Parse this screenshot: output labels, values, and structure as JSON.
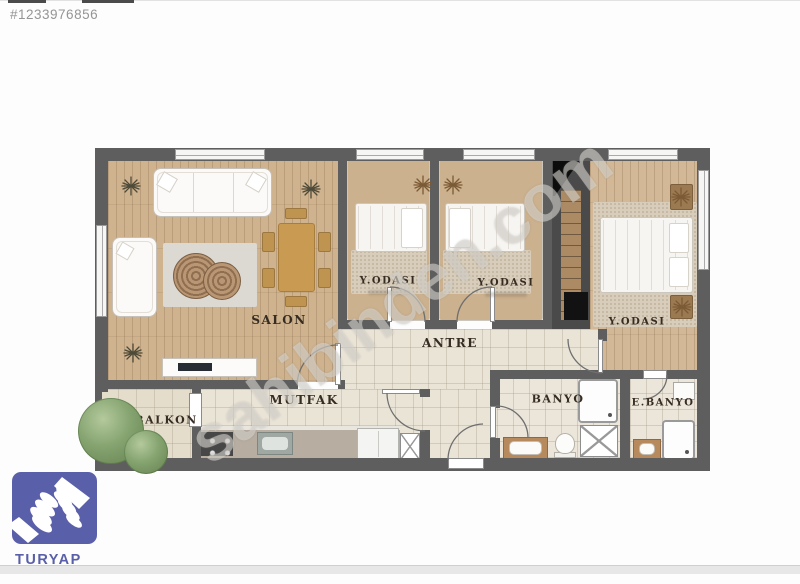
{
  "listing": {
    "id": "#1233976856"
  },
  "watermark": {
    "text": "sahibinden.com"
  },
  "branding": {
    "name": "TURYAP",
    "icon": "handshake-icon",
    "color": "#5a5fa9"
  },
  "floorplan": {
    "rooms": {
      "salon": {
        "label": "SALON"
      },
      "bedroom1": {
        "label": "Y.ODASI"
      },
      "bedroom2": {
        "label": "Y.ODASI"
      },
      "bedroom3": {
        "label": "Y.ODASI"
      },
      "antre": {
        "label": "ANTRE"
      },
      "kitchen": {
        "label": "MUTFAK"
      },
      "balcony": {
        "label": "BALKON"
      },
      "bathroom": {
        "label": "BANYO"
      },
      "ensuite_bathroom": {
        "label": "E.BANYO"
      }
    },
    "colors": {
      "wall": "#5e5e5e",
      "wood_floor": "#cfb38f",
      "tile_floor": "#eae4d7",
      "tree_green": "#85a470"
    }
  }
}
